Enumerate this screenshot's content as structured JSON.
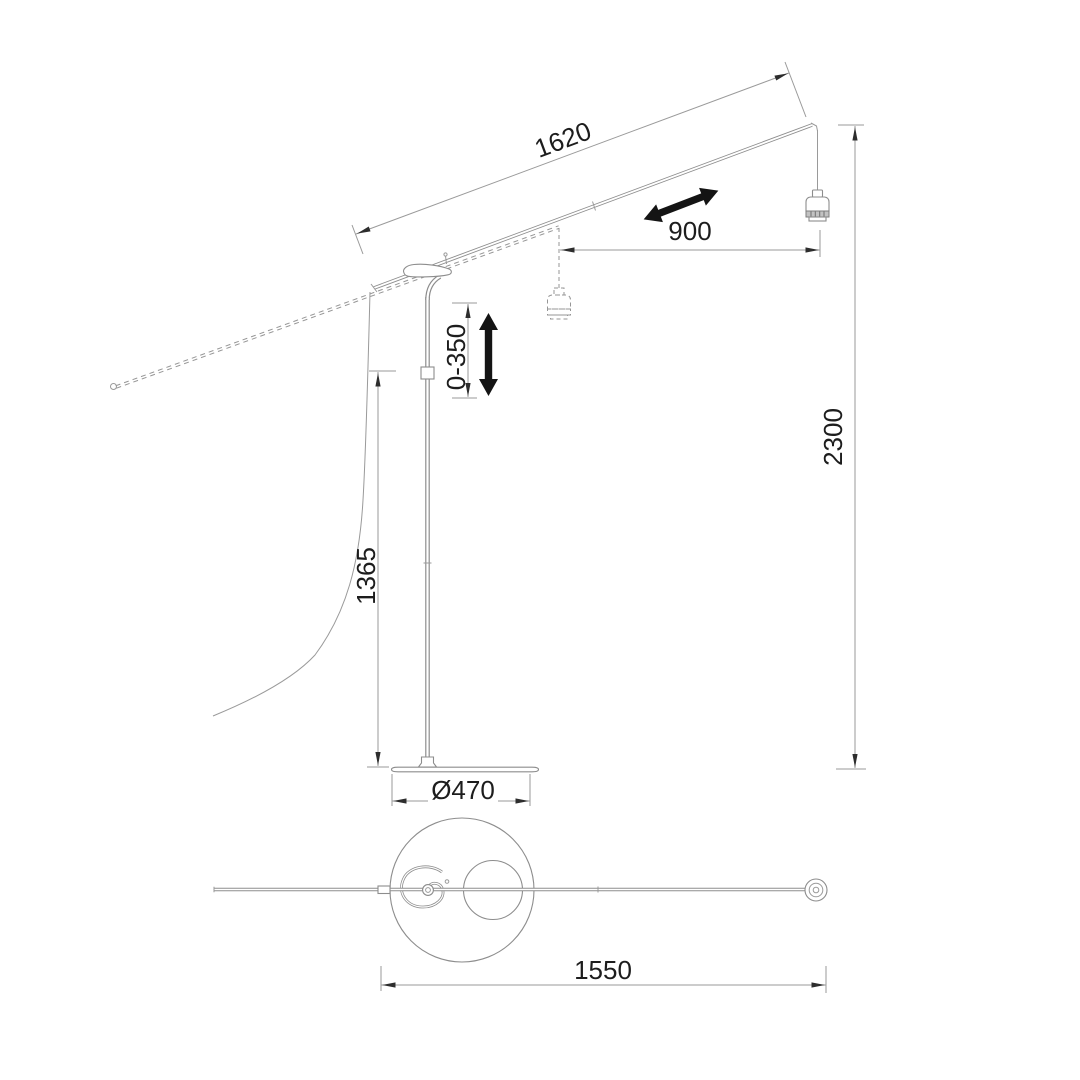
{
  "drawing": {
    "title": "arc floor lamp dimension drawing",
    "views": {
      "side_view": "side elevation of floor lamp with sliding boom arm and hanging lamp socket",
      "top_view": "plan view of round base, coiled cable and boom arm"
    }
  },
  "colors": {
    "background": "#ffffff",
    "drawing_line": "#8d8d8d",
    "dimension_line": "#9a9a9a",
    "text": "#1d1d1d",
    "bold_arrow": "#141414"
  },
  "dimensions": {
    "arm_length": "1620",
    "slide_range": "900",
    "height_adjustment": "0-350",
    "pole_height": "1365",
    "total_height": "2300",
    "base_diameter": "Ø470",
    "overall_length_top": "1550"
  },
  "icons": {
    "slide_direction_arrow": "double-headed arrow along boom",
    "lift_direction_arrow": "double-headed vertical arrow"
  }
}
